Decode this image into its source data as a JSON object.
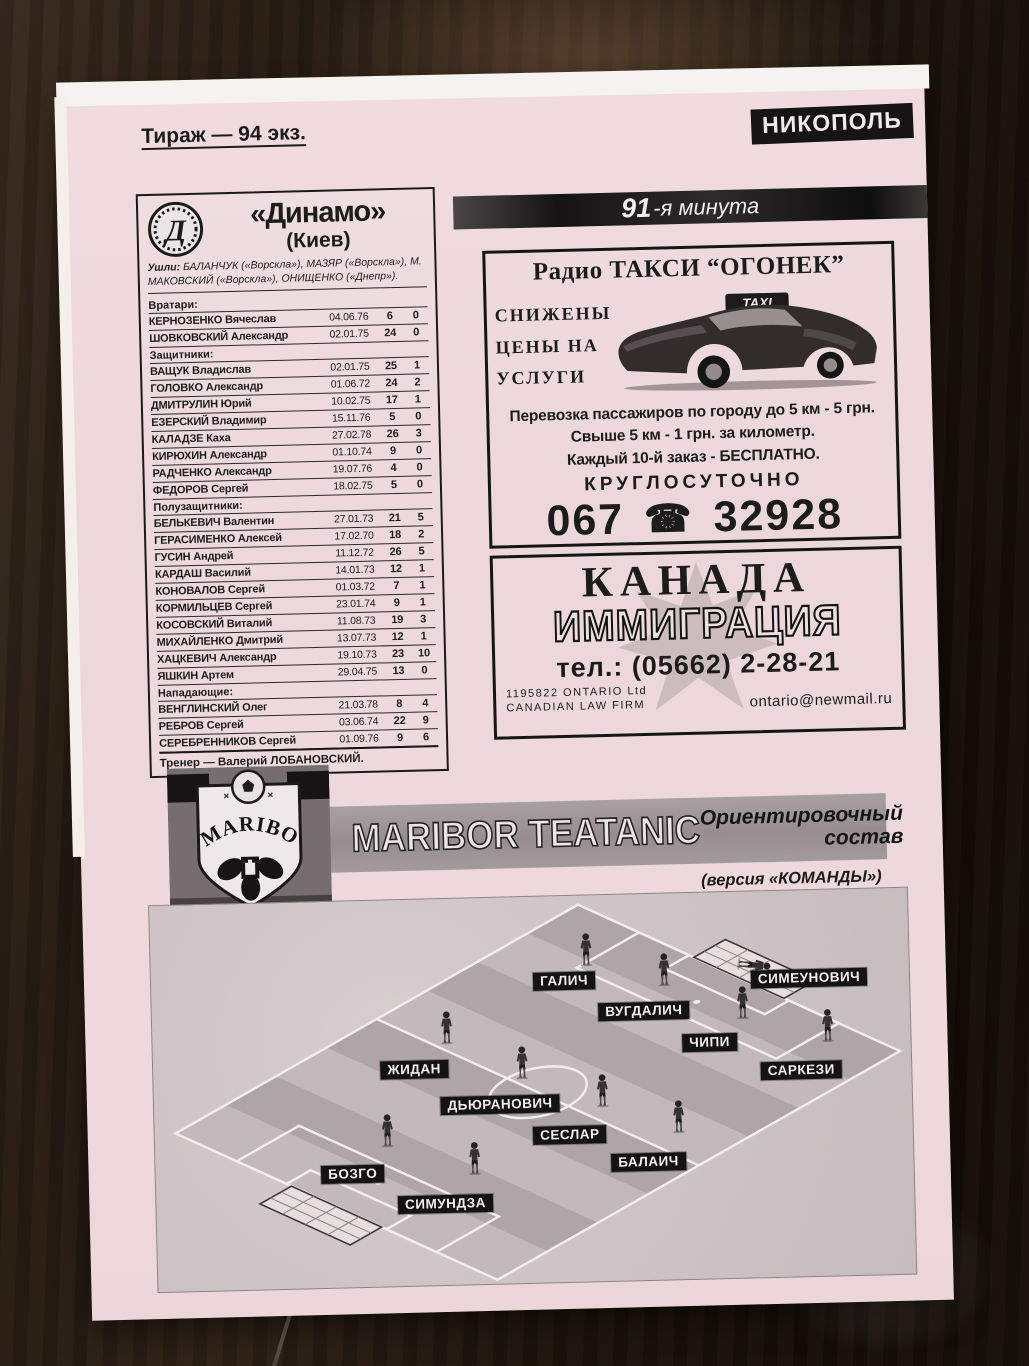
{
  "header": {
    "tirazh": "Тираж — 94 экз.",
    "city_badge": "НИКОПОЛЬ"
  },
  "minute_banner": {
    "number": "91",
    "rest": "-я минута"
  },
  "dynamo": {
    "title": "«Динамо»",
    "subtitle": "(Киев)",
    "departures_label": "Ушли:",
    "departures": "БАЛАНЧУК («Ворскла»), МАЗЯР («Ворскла»), М. МАКОВСКИЙ («Ворскла»), ОНИЩЕНКО («Днепр»).",
    "sections": [
      {
        "title": "Вратари:",
        "players": [
          [
            "КЕРНОЗЕНКО Вячеслав",
            "04.06.76",
            "6",
            "0"
          ],
          [
            "ШОВКОВСКИЙ Александр",
            "02.01.75",
            "24",
            "0"
          ]
        ]
      },
      {
        "title": "Защитники:",
        "players": [
          [
            "ВАЩУК Владислав",
            "02.01.75",
            "25",
            "1"
          ],
          [
            "ГОЛОВКО Александр",
            "01.06.72",
            "24",
            "2"
          ],
          [
            "ДМИТРУЛИН Юрий",
            "10.02.75",
            "17",
            "1"
          ],
          [
            "ЕЗЕРСКИЙ Владимир",
            "15.11.76",
            "5",
            "0"
          ],
          [
            "КАЛАДЗЕ Каха",
            "27.02.78",
            "26",
            "3"
          ],
          [
            "КИРЮХИН Александр",
            "01.10.74",
            "9",
            "0"
          ],
          [
            "РАДЧЕНКО Александр",
            "19.07.76",
            "4",
            "0"
          ],
          [
            "ФЕДОРОВ Сергей",
            "18.02.75",
            "5",
            "0"
          ]
        ]
      },
      {
        "title": "Полузащитники:",
        "players": [
          [
            "БЕЛЬКЕВИЧ Валентин",
            "27.01.73",
            "21",
            "5"
          ],
          [
            "ГЕРАСИМЕНКО Алексей",
            "17.02.70",
            "18",
            "2"
          ],
          [
            "ГУСИН Андрей",
            "11.12.72",
            "26",
            "5"
          ],
          [
            "КАРДАШ Василий",
            "14.01.73",
            "12",
            "1"
          ],
          [
            "КОНОВАЛОВ Сергей",
            "01.03.72",
            "7",
            "1"
          ],
          [
            "КОРМИЛЬЦЕВ Сергей",
            "23.01.74",
            "9",
            "1"
          ],
          [
            "КОСОВСКИЙ Виталий",
            "11.08.73",
            "19",
            "3"
          ],
          [
            "МИХАЙЛЕНКО Дмитрий",
            "13.07.73",
            "12",
            "1"
          ],
          [
            "ХАЦКЕВИЧ Александр",
            "19.10.73",
            "23",
            "10"
          ],
          [
            "ЯШКИН Артем",
            "29.04.75",
            "13",
            "0"
          ]
        ]
      },
      {
        "title": "Нападающие:",
        "players": [
          [
            "ВЕНГЛИНСКИЙ Олег",
            "21.03.78",
            "8",
            "4"
          ],
          [
            "РЕБРОВ Сергей",
            "03.06.74",
            "22",
            "9"
          ],
          [
            "СЕРЕБРЕННИКОВ Сергей",
            "01.09.76",
            "9",
            "6"
          ]
        ]
      }
    ],
    "coach": "Тренер — Валерий ЛОБАНОВСКИЙ."
  },
  "taxi_ad": {
    "title": "Радио ТАКСИ “ОГОНЕК”",
    "slogan_lines": [
      "СНИЖЕНЫ",
      "ЦЕНЫ НА",
      "УСЛУГИ"
    ],
    "taxi_sign": "TAXI",
    "lines": [
      "Перевозка пассажиров по городу до 5 км - 5 грн.",
      "Свыше 5 км - 1 грн. за километр.",
      "Каждый 10-й заказ - БЕСПЛАТНО."
    ],
    "always": "КРУГЛОСУТОЧНО",
    "phone_prefix": "067",
    "phone_icon": "☎",
    "phone_number": "32928"
  },
  "canada_ad": {
    "line1": "КАНАДА",
    "line2": "ИММИГРАЦИЯ",
    "phone": "тел.: (05662) 2-28-21",
    "reg_line1": "1195822 ONTARIO Ltd",
    "reg_line2": "CANADIAN LAW FIRM",
    "email": "ontario@newmail.ru"
  },
  "maribor": {
    "logo_text": "MARIBOR",
    "title": "MARIBOR TEATANIC",
    "subtitle_line1": "Ориентировочный",
    "subtitle_line2": "состав",
    "version": "(версия «КОМАНДЫ»)",
    "players": [
      {
        "name": "СИМЕУНОВИЧ",
        "role": "goalkeeper",
        "label_x": 658,
        "label_y": 88,
        "sprite_x": 606,
        "sprite_y": 74
      },
      {
        "name": "ГАЛИЧ",
        "role": "field",
        "label_x": 413,
        "label_y": 85,
        "sprite_x": 437,
        "sprite_y": 54
      },
      {
        "name": "ВУГДАЛИЧ",
        "role": "field",
        "label_x": 492,
        "label_y": 117,
        "sprite_x": 515,
        "sprite_y": 76
      },
      {
        "name": "ЧИПИ",
        "role": "field",
        "label_x": 557,
        "label_y": 150,
        "sprite_x": 593,
        "sprite_y": 111
      },
      {
        "name": "САРКЕЗИ",
        "role": "field",
        "label_x": 648,
        "label_y": 180,
        "sprite_x": 678,
        "sprite_y": 136
      },
      {
        "name": "ЖИДАН",
        "role": "field",
        "label_x": 261,
        "label_y": 170,
        "sprite_x": 295,
        "sprite_y": 129
      },
      {
        "name": "ДЬЮРАНОВИЧ",
        "role": "field",
        "label_x": 346,
        "label_y": 207,
        "sprite_x": 370,
        "sprite_y": 166
      },
      {
        "name": "СЕСЛАР",
        "role": "field",
        "label_x": 415,
        "label_y": 239,
        "sprite_x": 450,
        "sprite_y": 196
      },
      {
        "name": "БАЛАИЧ",
        "role": "field",
        "label_x": 493,
        "label_y": 268,
        "sprite_x": 526,
        "sprite_y": 224
      },
      {
        "name": "БОЗГО",
        "role": "field",
        "label_x": 197,
        "label_y": 273,
        "sprite_x": 233,
        "sprite_y": 231
      },
      {
        "name": "СИМУНДЗА",
        "role": "field",
        "label_x": 289,
        "label_y": 305,
        "sprite_x": 320,
        "sprite_y": 261
      }
    ]
  }
}
